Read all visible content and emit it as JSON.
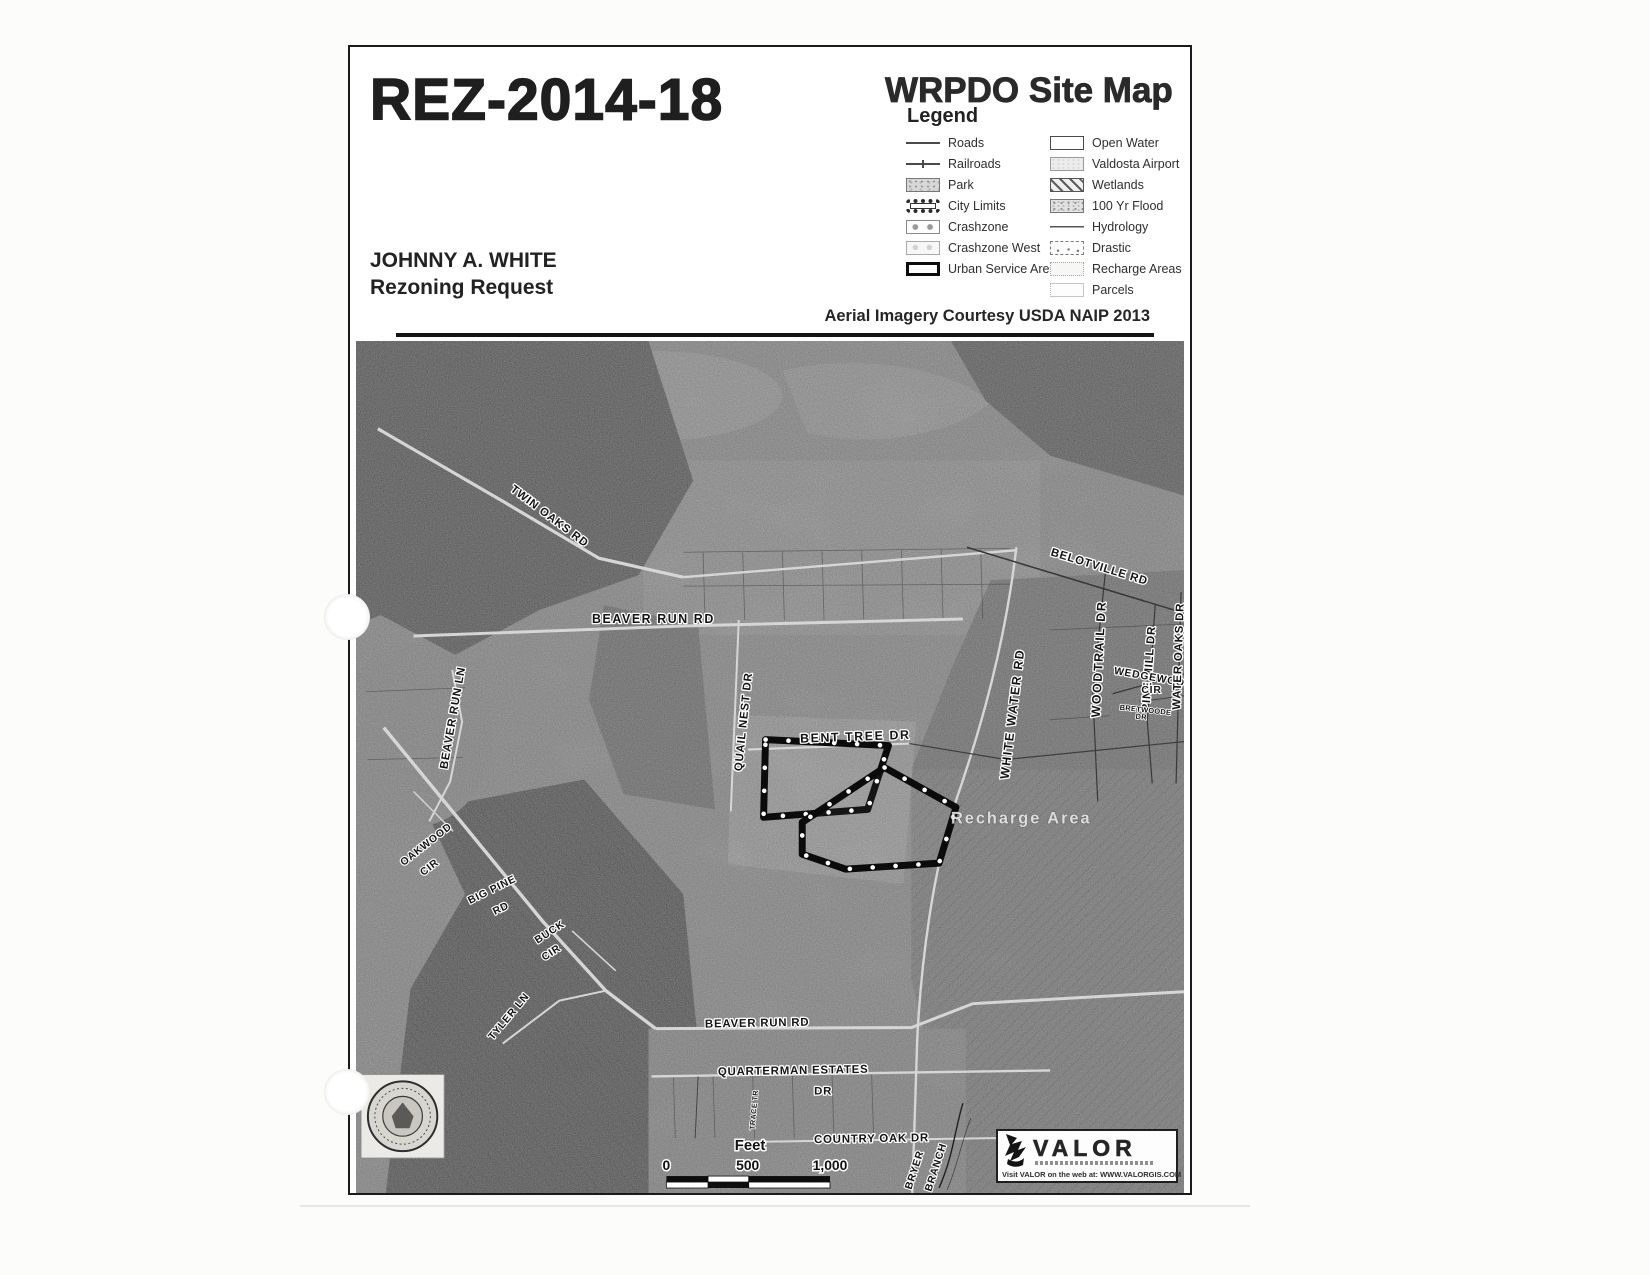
{
  "header": {
    "case_number": "REZ-2014-18",
    "map_title": "WRPDO Site Map",
    "applicant_line1": "JOHNNY A. WHITE",
    "applicant_line2": "Rezoning Request",
    "imagery_credit": "Aerial Imagery Courtesy USDA NAIP 2013"
  },
  "legend": {
    "title": "Legend",
    "left_items": [
      {
        "label": "Roads",
        "swatch": "road-line"
      },
      {
        "label": "Railroads",
        "swatch": "railroad-line"
      },
      {
        "label": "Park",
        "swatch": "park-fill"
      },
      {
        "label": "City Limits",
        "swatch": "city-limits-band"
      },
      {
        "label": "Crashzone",
        "swatch": "crashzone-fill"
      },
      {
        "label": "Crashzone West",
        "swatch": "crashzone-west-fill"
      },
      {
        "label": "Urban Service Area",
        "swatch": "thick-outline"
      }
    ],
    "right_items": [
      {
        "label": "Open Water",
        "swatch": "white-fill"
      },
      {
        "label": "Valdosta Airport",
        "swatch": "light-stipple"
      },
      {
        "label": "Wetlands",
        "swatch": "diagonal-hatch"
      },
      {
        "label": "100 Yr Flood",
        "swatch": "stipple"
      },
      {
        "label": "Hydrology",
        "swatch": "hydro-line"
      },
      {
        "label": "Drastic",
        "swatch": "dashed-dots"
      },
      {
        "label": "Recharge Areas",
        "swatch": "dotted-outline"
      },
      {
        "label": "Parcels",
        "swatch": "parcel-outline"
      }
    ]
  },
  "map": {
    "labels": {
      "twin_oaks": "TWIN OAKS RD",
      "beaver_run_rd_upper": "BEAVER RUN RD",
      "quail_nest": "QUAIL NEST DR",
      "bent_tree": "BENT TREE DR",
      "white_water": "WHITE WATER RD",
      "belotville": "BELOTVILLE RD",
      "woodtrail": "WOODTRAIL DR",
      "pine_mill": "PINE MILL DR",
      "wedgewood_line1": "WEDGEWOOD",
      "wedgewood_line2": "CIR",
      "water_oaks": "WATER OAKS DR",
      "bretwoode_line1": "BRETWOODE",
      "bretwoode_line2": "DR",
      "recharge_area": "Recharge Area",
      "beaver_run_ln": "BEAVER RUN LN",
      "oakwood_line1": "OAKWOOD",
      "oakwood_line2": "CIR",
      "big_pine_line1": "BIG PINE",
      "big_pine_line2": "RD",
      "buck_line1": "BUCK",
      "buck_line2": "CIR",
      "tyler_ln": "TYLER LN",
      "beaver_run_rd_lower": "BEAVER RUN RD",
      "quarterman_line1": "QUARTERMAN ESTATES",
      "quarterman_line2": "DR",
      "trace_tr": "TRACE TR",
      "country_oak": "COUNTRY OAK DR",
      "bryer_line1": "BRYER",
      "bryer_line2": "BRANCH"
    },
    "scale_bar": {
      "unit": "Feet",
      "tick_0": "0",
      "tick_500": "500",
      "tick_1000": "1,000"
    }
  },
  "footer": {
    "valor_name": "VALOR",
    "valor_web_line": "Visit VALOR on the web at: WWW.VALORGIS.COM"
  }
}
